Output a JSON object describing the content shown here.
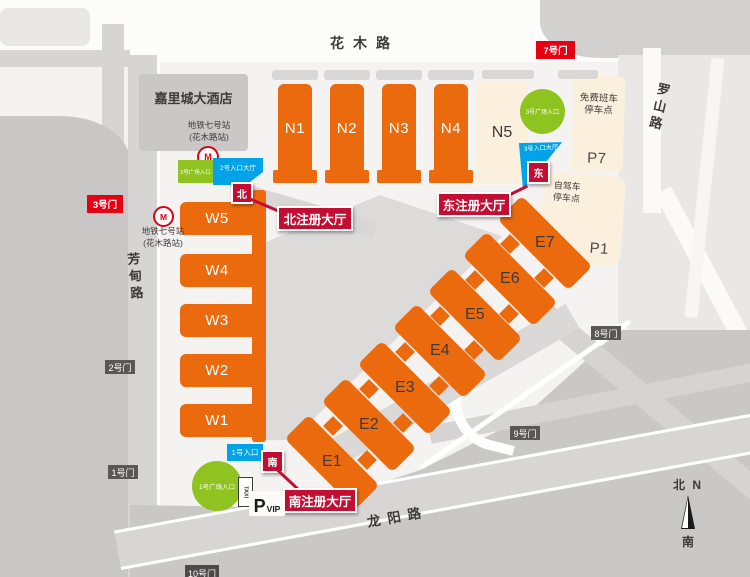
{
  "colors": {
    "hall_orange": "#ec6a0e",
    "parking_cream": "#fbf0dd",
    "entrance_green": "#8fc320",
    "entrance_blue": "#00a2e8",
    "gate_red": "#e60013",
    "registration_crimson": "#c30e33",
    "gate_gray": "#5a5857",
    "text_dark": "#3e3a39"
  },
  "roads": {
    "huamu": "花木路",
    "luoshan": "罗山路",
    "fangdian": "芳甸路",
    "longyang": "龙阳路"
  },
  "halls": {
    "west": [
      {
        "label": "W5"
      },
      {
        "label": "W4"
      },
      {
        "label": "W3"
      },
      {
        "label": "W2"
      },
      {
        "label": "W1"
      }
    ],
    "north": [
      {
        "label": "N1"
      },
      {
        "label": "N2"
      },
      {
        "label": "N3"
      },
      {
        "label": "N4"
      }
    ],
    "n5": {
      "label": "N5"
    },
    "east": [
      {
        "label": "E1"
      },
      {
        "label": "E2"
      },
      {
        "label": "E3"
      },
      {
        "label": "E4"
      },
      {
        "label": "E5"
      },
      {
        "label": "E6"
      },
      {
        "label": "E7"
      }
    ]
  },
  "gates": {
    "g7": "7号门",
    "g3": "3号门",
    "g2": "2号门",
    "g1": "1号门",
    "g8": "8号门",
    "g9": "9号门",
    "g10": "10号门"
  },
  "entrances": {
    "plaza2": "2号广场入口",
    "hall2": "2号入口大厅",
    "plaza3": "3号广场入口",
    "hall3": "3号入口大厅",
    "plaza1": "1号广场入口",
    "entry1": "1号入口"
  },
  "registration": {
    "north_badge": "北",
    "east_badge": "东",
    "south_badge": "南",
    "north_label": "北注册大厅",
    "east_label": "东注册大厅",
    "south_label": "南注册大厅"
  },
  "landmarks": {
    "hotel": "嘉里城大酒店",
    "metro_line1": "地铁七号站",
    "metro_line2": "(花木路站)",
    "metro_logo": "M",
    "shuttle_line1": "免费班车",
    "shuttle_line2": "停车点",
    "selfdrive_line1": "自驾车",
    "selfdrive_line2": "停车点",
    "p7": "P7",
    "p1": "P1",
    "taxi": "TAXI",
    "vip_p": "P",
    "vip": "VIP"
  },
  "compass": {
    "north": "北 N",
    "south": "南"
  }
}
